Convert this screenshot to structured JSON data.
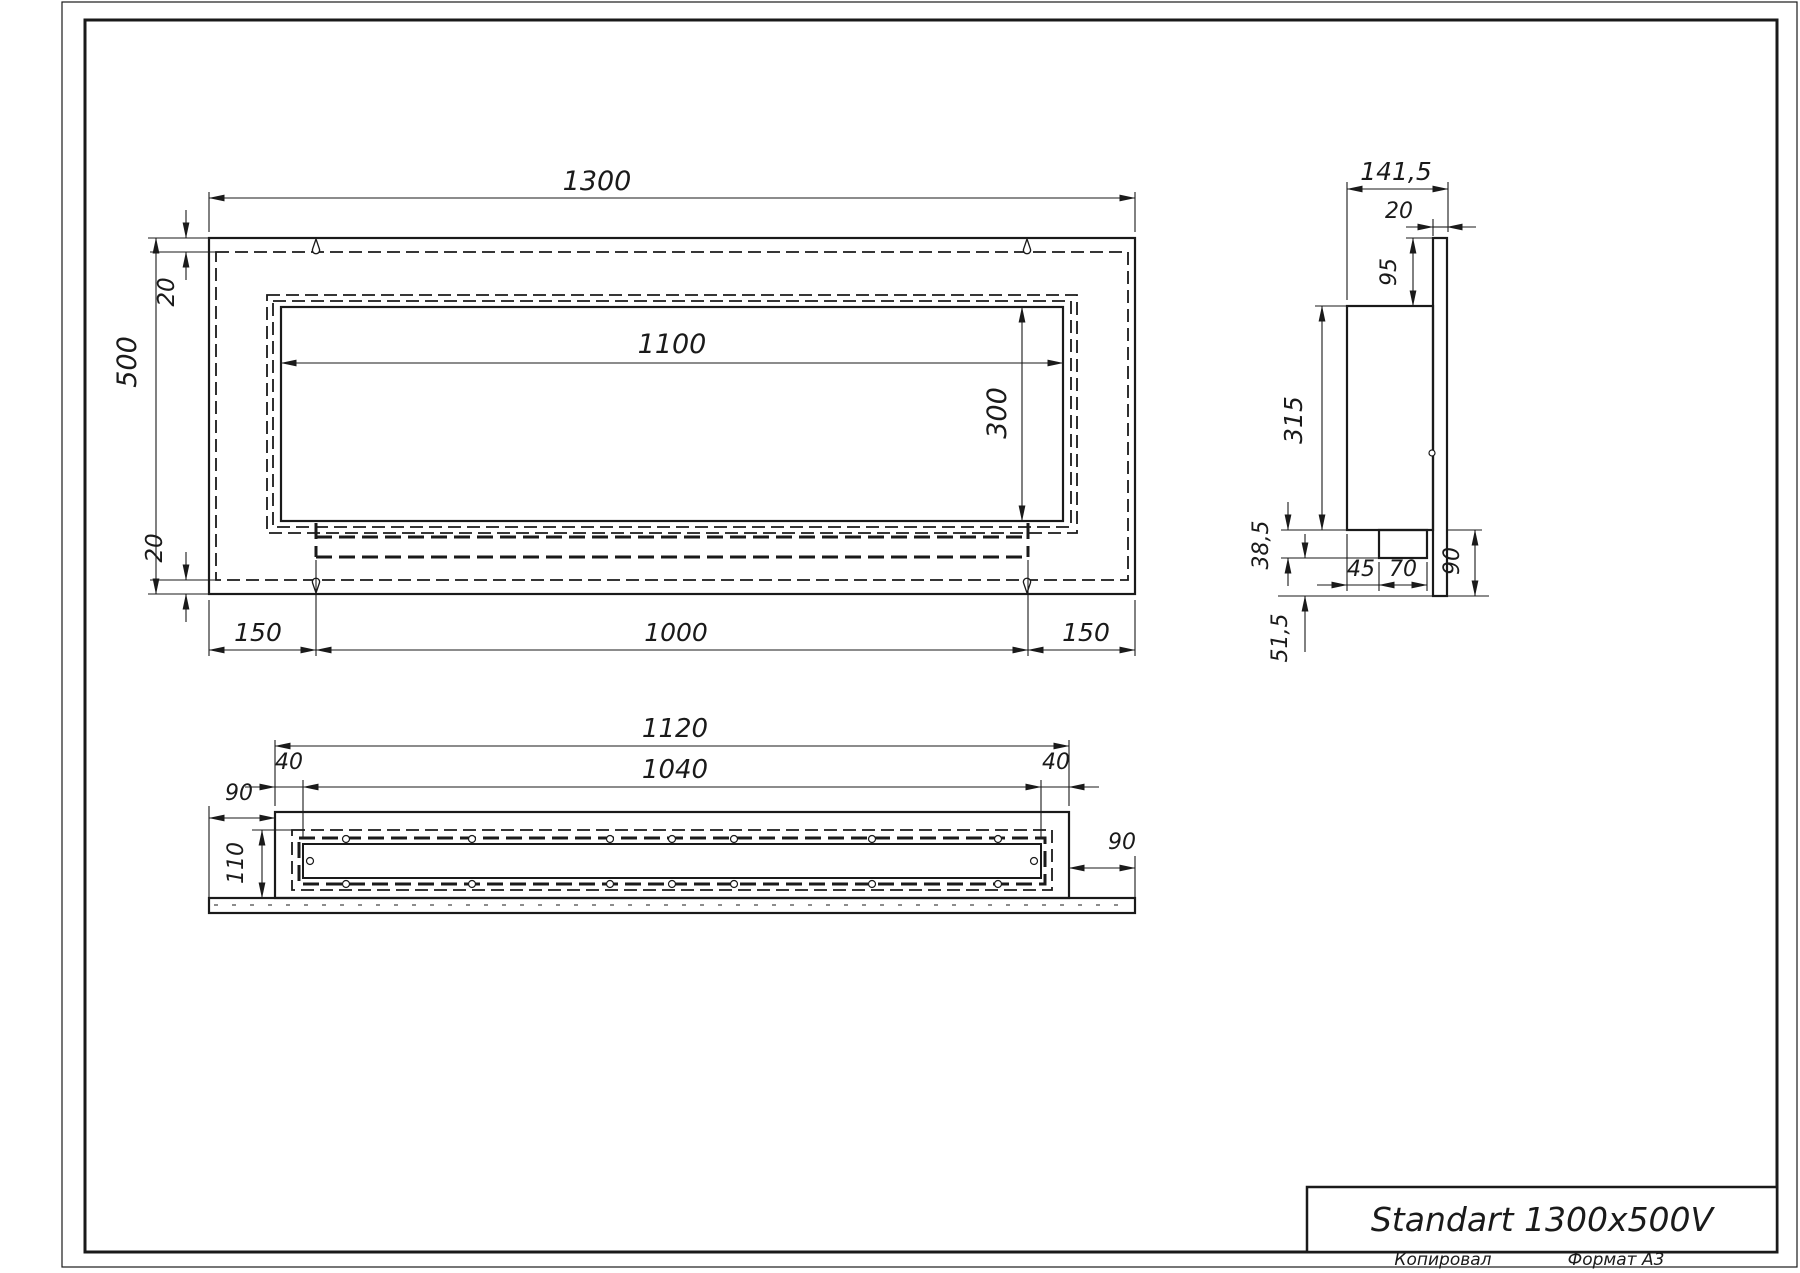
{
  "front": {
    "width": "1300",
    "height": "500",
    "top_offset": "20",
    "bottom_offset": "20",
    "left_margin": "150",
    "burner_width": "1000",
    "right_margin": "150",
    "opening_width": "1100",
    "opening_height": "300"
  },
  "side": {
    "depth": "141,5",
    "plate_thickness": "20",
    "top_inset": "95",
    "body_height": "315",
    "bracket_offset": "38,5",
    "bottom_offset": "51,5",
    "bracket_x": "45",
    "bracket_width": "70",
    "plate_margin": "90"
  },
  "bottom": {
    "width": "1120",
    "inner_width": "1040",
    "left_offset": "40",
    "right_offset": "40",
    "left_margin": "90",
    "right_margin": "90",
    "depth": "110"
  },
  "title_block": {
    "title": "Standart 1300x500V",
    "copied": "Копировал",
    "format": "Формат А3"
  },
  "drawing": {
    "line_color": "#1a1a1a",
    "background": "#ffffff"
  }
}
